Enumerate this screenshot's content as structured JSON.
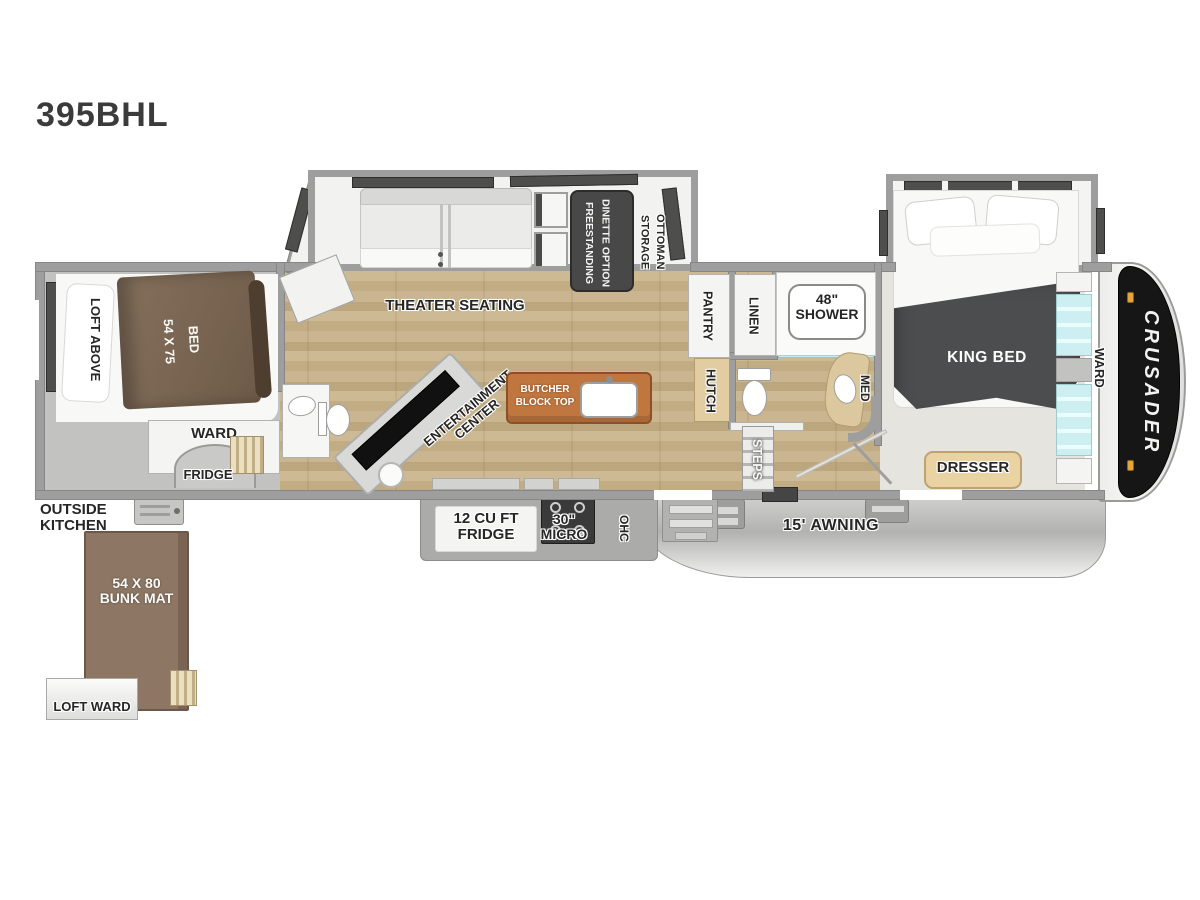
{
  "model": "395BHL",
  "brand": "CRUSADER",
  "labels": {
    "loft_above": "LOFT ABOVE",
    "bunk_bed": "54 X 75\nBED",
    "bunk_ward": "WARD",
    "bunk_fridge": "FRIDGE",
    "outside_kitchen": "OUTSIDE\nKITCHEN",
    "bunk_mat": "54 X 80\nBUNK MAT",
    "loft_ward": "LOFT WARD",
    "theater_seating": "THEATER SEATING",
    "dinette": "FREESTANDING\nDINETTE OPTION",
    "storage_ottoman": "STORAGE\nOTTOMAN",
    "entertainment_center": "ENTERTAINMENT\nCENTER",
    "butcher_block": "BUTCHER\nBLOCK TOP",
    "fridge12": "12 CU FT\nFRIDGE",
    "micro": "30\"\nMICRO",
    "ohc": "OHC",
    "pantry": "PANTRY",
    "hutch": "HUTCH",
    "linen": "LINEN",
    "shower": "48\"\nSHOWER",
    "med": "MED",
    "steps": "STEPS",
    "king_bed": "KING BED",
    "bedroom_ward": "WARD",
    "dresser": "DRESSER",
    "awning": "15' AWNING"
  },
  "colors": {
    "wall": "#9e9e9e",
    "wood_floor": "#c8b48e",
    "bunk_floor": "#c2c2c0",
    "bedroom_floor": "#e6e4de",
    "accent_teal": "#cdeff2",
    "butcher_top": "#c0763f",
    "bunk_bed_brown": "#7a6451",
    "bunk_mat_brown": "#8d7764",
    "king_blanket": "#4b4d4f",
    "cap_black": "#161616",
    "awning_gray": "#c0c0be",
    "clearance_light_orange": "#e8a43c"
  }
}
